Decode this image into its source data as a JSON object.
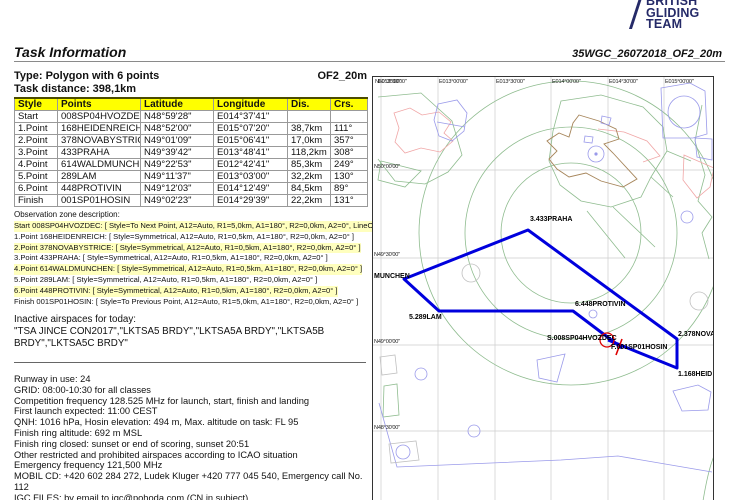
{
  "logo": {
    "line1": "BRITISH",
    "line2": "GLIDING",
    "line3": "TEAM",
    "color": "#252a68"
  },
  "header": {
    "title": "Task Information",
    "doc_ref": "35WGC_26072018_OF2_20m"
  },
  "task_summary": {
    "type": "Type: Polygon with 6 points",
    "code": "OF2_20m",
    "distance": "Task distance: 398,1km"
  },
  "waypoint_table": {
    "headers": [
      "Style",
      "Points",
      "Latitude",
      "Longitude",
      "Dis.",
      "Crs."
    ],
    "rows": [
      [
        "Start",
        "008SP04HVOZDEC",
        "N48°59'28\"",
        "E014°37'41\"",
        "",
        ""
      ],
      [
        "1.Point",
        "168HEIDENREICH",
        "N48°52'00\"",
        "E015°07'20\"",
        "38,7km",
        "111°"
      ],
      [
        "2.Point",
        "378NOVABYSTRICE",
        "N49°01'09\"",
        "E015°06'41\"",
        "17,0km",
        "357°"
      ],
      [
        "3.Point",
        "433PRAHA",
        "N49°39'42\"",
        "E013°48'41\"",
        "118,2km",
        "308°"
      ],
      [
        "4.Point",
        "614WALDMUNCHEN",
        "N49°22'53\"",
        "E012°42'41\"",
        "85,3km",
        "249°"
      ],
      [
        "5.Point",
        "289LAM",
        "N49°11'37\"",
        "E013°03'00\"",
        "32,2km",
        "130°"
      ],
      [
        "6.Point",
        "448PROTIVIN",
        "N49°12'03\"",
        "E014°12'49\"",
        "84,5km",
        "89°"
      ],
      [
        "Finish",
        "001SP01HOSIN",
        "N49°02'23\"",
        "E014°29'39\"",
        "22,2km",
        "131°"
      ]
    ]
  },
  "observation_zones": {
    "title": "Observation zone description:",
    "lines": [
      {
        "text": "Start 008SP04HVOZDEC: [ Style=To Next Point, A12=Auto, R1=5,0km, A1=180°, R2=0,0km, A2=0°, LineOnly",
        "highlight": true
      },
      {
        "text": "1.Point 168HEIDENREICH: [ Style=Symmetrical, A12=Auto, R1=0,5km, A1=180°, R2=0,0km, A2=0° ]",
        "highlight": false
      },
      {
        "text": "2.Point 378NOVABYSTRICE: [ Style=Symmetrical, A12=Auto, R1=0,5km, A1=180°, R2=0,0km, A2=0° ]",
        "highlight": true
      },
      {
        "text": "3.Point 433PRAHA: [ Style=Symmetrical, A12=Auto, R1=0,5km, A1=180°, R2=0,0km, A2=0° ]",
        "highlight": false
      },
      {
        "text": "4.Point 614WALDMUNCHEN: [ Style=Symmetrical, A12=Auto, R1=0,5km, A1=180°, R2=0,0km, A2=0° ]",
        "highlight": true
      },
      {
        "text": "5.Point 289LAM: [ Style=Symmetrical, A12=Auto, R1=0,5km, A1=180°, R2=0,0km, A2=0° ]",
        "highlight": false
      },
      {
        "text": "6.Point 448PROTIVIN: [ Style=Symmetrical, A12=Auto, R1=0,5km, A1=180°, R2=0,0km, A2=0° ]",
        "highlight": true
      },
      {
        "text": "Finish 001SP01HOSIN: [ Style=To Previous Point, A12=Auto, R1=5,0km, A1=180°, R2=0,0km, A2=0° ]",
        "highlight": false
      }
    ]
  },
  "inactive_airspaces": {
    "title": "Inactive airspaces for today:",
    "list": "\"TSA JINCE CON2017\",\"LKTSA5 BRDY\",\"LKTSA5A BRDY\",\"LKTSA5B BRDY\",\"LKTSA5C BRDY\""
  },
  "briefing_lines": [
    "Runway in use: 24",
    "GRID: 08:00-10:30 for all classes",
    "Competition frequency 128.525 MHz for launch, start, finish and landing",
    "First launch expected: 11:00 CEST",
    "QNH: 1016 hPa, Hosin elevation: 494 m, Max. altitude on task: FL 95",
    "Finish ring altitude: 692 m MSL",
    "Finish ring closed: sunset or end of scoring, sunset 20:51",
    "Other restricted and prohibited airspaces according to ICAO situation",
    "Emergency frequency 121,500 MHz",
    "MOBIL CD: +420 602 284 272, Ludek Kluger +420 777 045 540, Emergency call No. 112",
    "IGC FILES: by email to igc@pohoda.com (CN in subject)"
  ],
  "map": {
    "grid_top_labels": [
      {
        "text": "N50°30'00\"",
        "x": 374
      },
      {
        "text": "E012°30'00\"",
        "x": 377
      },
      {
        "text": "E013°00'00\"",
        "x": 438
      },
      {
        "text": "E013°30'00\"",
        "x": 495
      },
      {
        "text": "E014°00'00\"",
        "x": 551
      },
      {
        "text": "E014°30'00\"",
        "x": 608
      },
      {
        "text": "E015°00'00\"",
        "x": 664
      }
    ],
    "grid_left_labels": [
      {
        "text": "N50°00'00\"",
        "y": 163
      },
      {
        "text": "N49°30'00\"",
        "y": 251
      },
      {
        "text": "N49°00'00\"",
        "y": 338
      },
      {
        "text": "N48°30'00\"",
        "y": 424
      }
    ],
    "waypoint_labels": [
      {
        "label": "3.433PRAHA",
        "x": 529,
        "y": 215
      },
      {
        "label": "MUNCHEN",
        "x": 373,
        "y": 272
      },
      {
        "label": "5.289LAM",
        "x": 408,
        "y": 313
      },
      {
        "label": "6.448PROTIVIN",
        "x": 574,
        "y": 300
      },
      {
        "label": "S.008SP04HVOZDEC",
        "x": 546,
        "y": 334
      },
      {
        "label": "F.001SP01HOSIN",
        "x": 610,
        "y": 343
      },
      {
        "label": "2.378NOVA",
        "x": 677,
        "y": 330
      },
      {
        "label": "1.168HEID",
        "x": 677,
        "y": 370
      }
    ],
    "task_route": [
      [
        607,
        339
      ],
      [
        676,
        367
      ],
      [
        676,
        338
      ],
      [
        527,
        229
      ],
      [
        403,
        278
      ],
      [
        438,
        310
      ],
      [
        572,
        310
      ],
      [
        621,
        347
      ]
    ],
    "start_circle": {
      "cx": 606,
      "cy": 339,
      "r": 7
    },
    "finish_tick": [
      [
        621,
        338
      ],
      [
        615,
        354
      ]
    ],
    "colors": {
      "task_line": "#0000dd",
      "start_mark": "#dd0000",
      "grid": "#cccccc",
      "table_header_bg": "#ffff00",
      "oz_highlight": "#ffffbe",
      "logo_navy": "#252a68"
    }
  }
}
